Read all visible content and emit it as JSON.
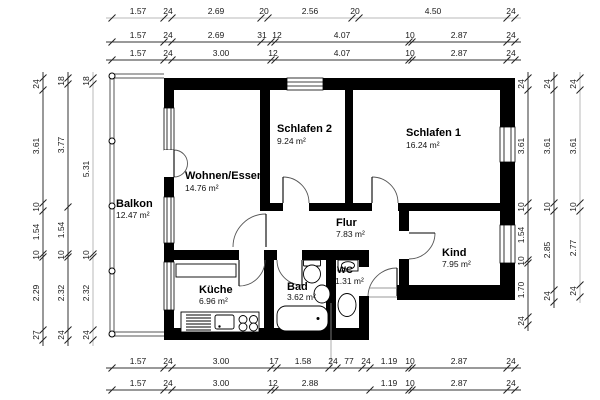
{
  "drawing_type": "floor-plan",
  "rooms": [
    {
      "name": "Balkon",
      "area": "12.47 m²"
    },
    {
      "name": "Wohnen/Essen",
      "area": "14.76 m²"
    },
    {
      "name": "Schlafen 2",
      "area": "9.24 m²"
    },
    {
      "name": "Schlafen 1",
      "area": "16.24 m²"
    },
    {
      "name": "Flur",
      "area": "7.83 m²"
    },
    {
      "name": "Kind",
      "area": "7.95 m²"
    },
    {
      "name": "Küche",
      "area": "6.96 m²"
    },
    {
      "name": "Bad",
      "area": "3.62 m²"
    },
    {
      "name": "WC",
      "area": "1.31 m²"
    }
  ],
  "dims": {
    "top1": [
      "1.57",
      "24",
      "2.69",
      "20",
      "2.56",
      "20",
      "4.50",
      "24"
    ],
    "top2": [
      "1.57",
      "24",
      "2.69",
      "31",
      "12",
      "4.07",
      "10",
      "2.87",
      "24"
    ],
    "top3": [
      "1.57",
      "24",
      "3.00",
      "12",
      "4.07",
      "10",
      "2.87",
      "24"
    ],
    "bottom1": [
      "1.57",
      "24",
      "3.00",
      "17",
      "1.58",
      "24",
      "77",
      "24",
      "1.19",
      "10",
      "2.87",
      "24"
    ],
    "bottom2": [
      "1.57",
      "24",
      "3.00",
      "12",
      "2.88",
      "1.19",
      "10",
      "2.87",
      "24"
    ],
    "left_outer": [
      "24",
      "3.61",
      "10",
      "1.54",
      "10",
      "2.29",
      "27"
    ],
    "left_mid": [
      "18",
      "3.77",
      "1.54",
      "10",
      "2.32",
      "24"
    ],
    "left_inner": [
      "18",
      "5.31",
      "10",
      "2.32",
      "24"
    ],
    "right_inner": [
      "24",
      "3.61",
      "10",
      "1.54",
      "10",
      "1.70",
      "24"
    ],
    "right_mid": [
      "24",
      "3.61",
      "10",
      "2.85",
      "24"
    ],
    "right_outer": [
      "24",
      "3.61",
      "10",
      "2.77",
      "24"
    ]
  },
  "colors": {
    "wall": "#000000",
    "dim_line": "#333333",
    "muted_dim_line": "#b9b9b9",
    "door_arc": "#555555"
  }
}
